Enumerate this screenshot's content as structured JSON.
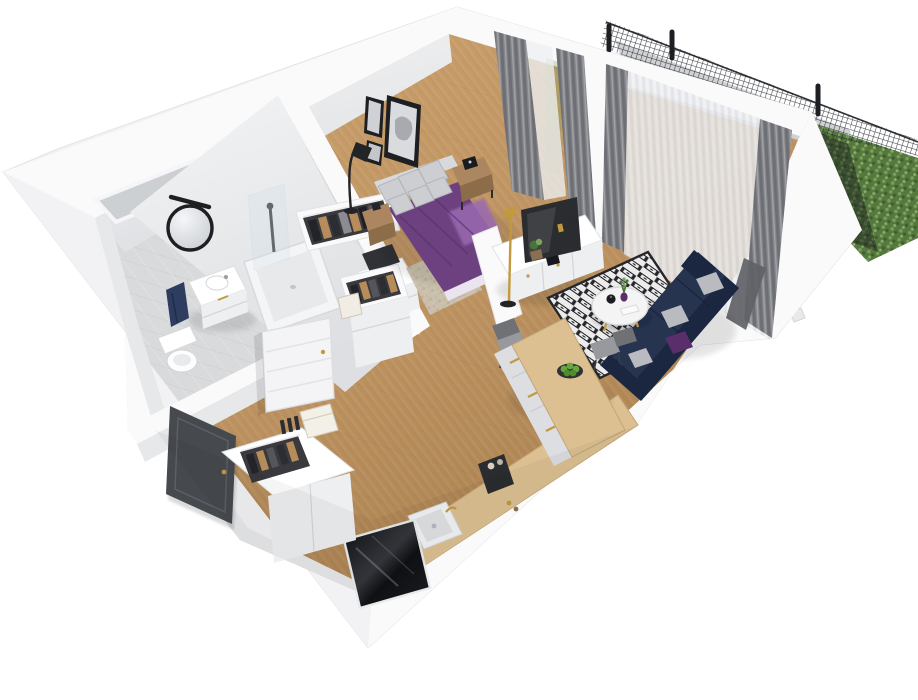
{
  "scene": {
    "kind": "3d-apartment-floorplan-render",
    "view": "isometric-cutaway-top",
    "rooms": [
      "bathroom",
      "hallway",
      "wardrobe-niche",
      "bedroom",
      "living-room",
      "kitchen",
      "balcony"
    ],
    "objects": {
      "bathroom": [
        "round-mirror",
        "mirror-light",
        "vanity-cabinet",
        "washbasin",
        "navy-towel",
        "bathtub",
        "shower-column",
        "glass-screen",
        "toilet",
        "laundry-drawer-unit"
      ],
      "bedroom": [
        "double-bed-purple-duvet",
        "gray-pillows",
        "wood-nightstand-left",
        "wood-nightstand-right",
        "black-alarm-clock",
        "wall-art-frames",
        "black-arc-floor-lamp",
        "beige-rug",
        "open-wardrobe-racks"
      ],
      "living-room": [
        "tv-partition-wall",
        "tv-screen",
        "white-sideboard",
        "potted-plant",
        "gold-floor-lamp",
        "diamond-pattern-rug",
        "round-coffee-table",
        "purple-vase",
        "black-teapot",
        "white-book",
        "navy-corner-sofa",
        "gray-cushions",
        "purple-cushion",
        "gray-dining-chairs"
      ],
      "kitchen": [
        "wood-peninsula-table",
        "drawer-fronts-gold-handles",
        "green-apple-plate",
        "black-kettle",
        "induction-hob",
        "wood-countertop",
        "white-sink-gold-faucet",
        "coffee-machine",
        "black-gloss-fridge"
      ],
      "hallway": [
        "dark-entry-door",
        "white-interior-door",
        "entry-closet-rack",
        "white-storage-cabinet",
        "book-stack"
      ],
      "balcony": [
        "gray-curtains",
        "sheer-curtains",
        "mesh-fence",
        "fence-posts",
        "green-hedge-wall",
        "balcony-table"
      ]
    }
  },
  "palette": {
    "bg": "#ffffff",
    "wall-outer": "#f2f2f4",
    "wall-top": "#fafafb",
    "wall-face": "#e7e8ea",
    "wall-face-dark": "#d2d4d7",
    "bath-tile": "#d8dadc",
    "balcony-tile": "#cfd1d4",
    "wood": "#c49a66",
    "wood-deep": "#a87f4c",
    "counter-wood": "#dcc092",
    "cabinet-white": "#eeeff1",
    "cabinet-shade": "#dcdee1",
    "duvet": "#6d4180",
    "duvet-light": "#9a6ab2",
    "duvet-dark": "#533069",
    "pillow": "#cdced2",
    "sofa": "#263450",
    "sofa-dark": "#1b2740",
    "cushion-gray": "#b9bbc0",
    "cushion-purple": "#5a2d6b",
    "rug-white": "#ececec",
    "rug-black": "#26262a",
    "rug-beige": "#ccc2b2",
    "curtain-gray": "#84868b",
    "curtain-dark": "#606267",
    "sheer": "#edeff2",
    "hedge": "#55783f",
    "hedge-light": "#7ba35c",
    "hedge-dark": "#3f5c2e",
    "mesh": "#2c2f33",
    "gold": "#c2993f",
    "wood-furn": "#ab8661",
    "wood-furn-dark": "#8d6c49",
    "chair": "#97999e",
    "chair-dark": "#6f7175",
    "door-dark": "#46494e",
    "appliance": "#1a1b1e",
    "tv": "#2a2c30",
    "towel": "#2e3c60",
    "apple": "#67a73d",
    "plant": "#47743a",
    "frame-dark": "#1e1f22"
  }
}
